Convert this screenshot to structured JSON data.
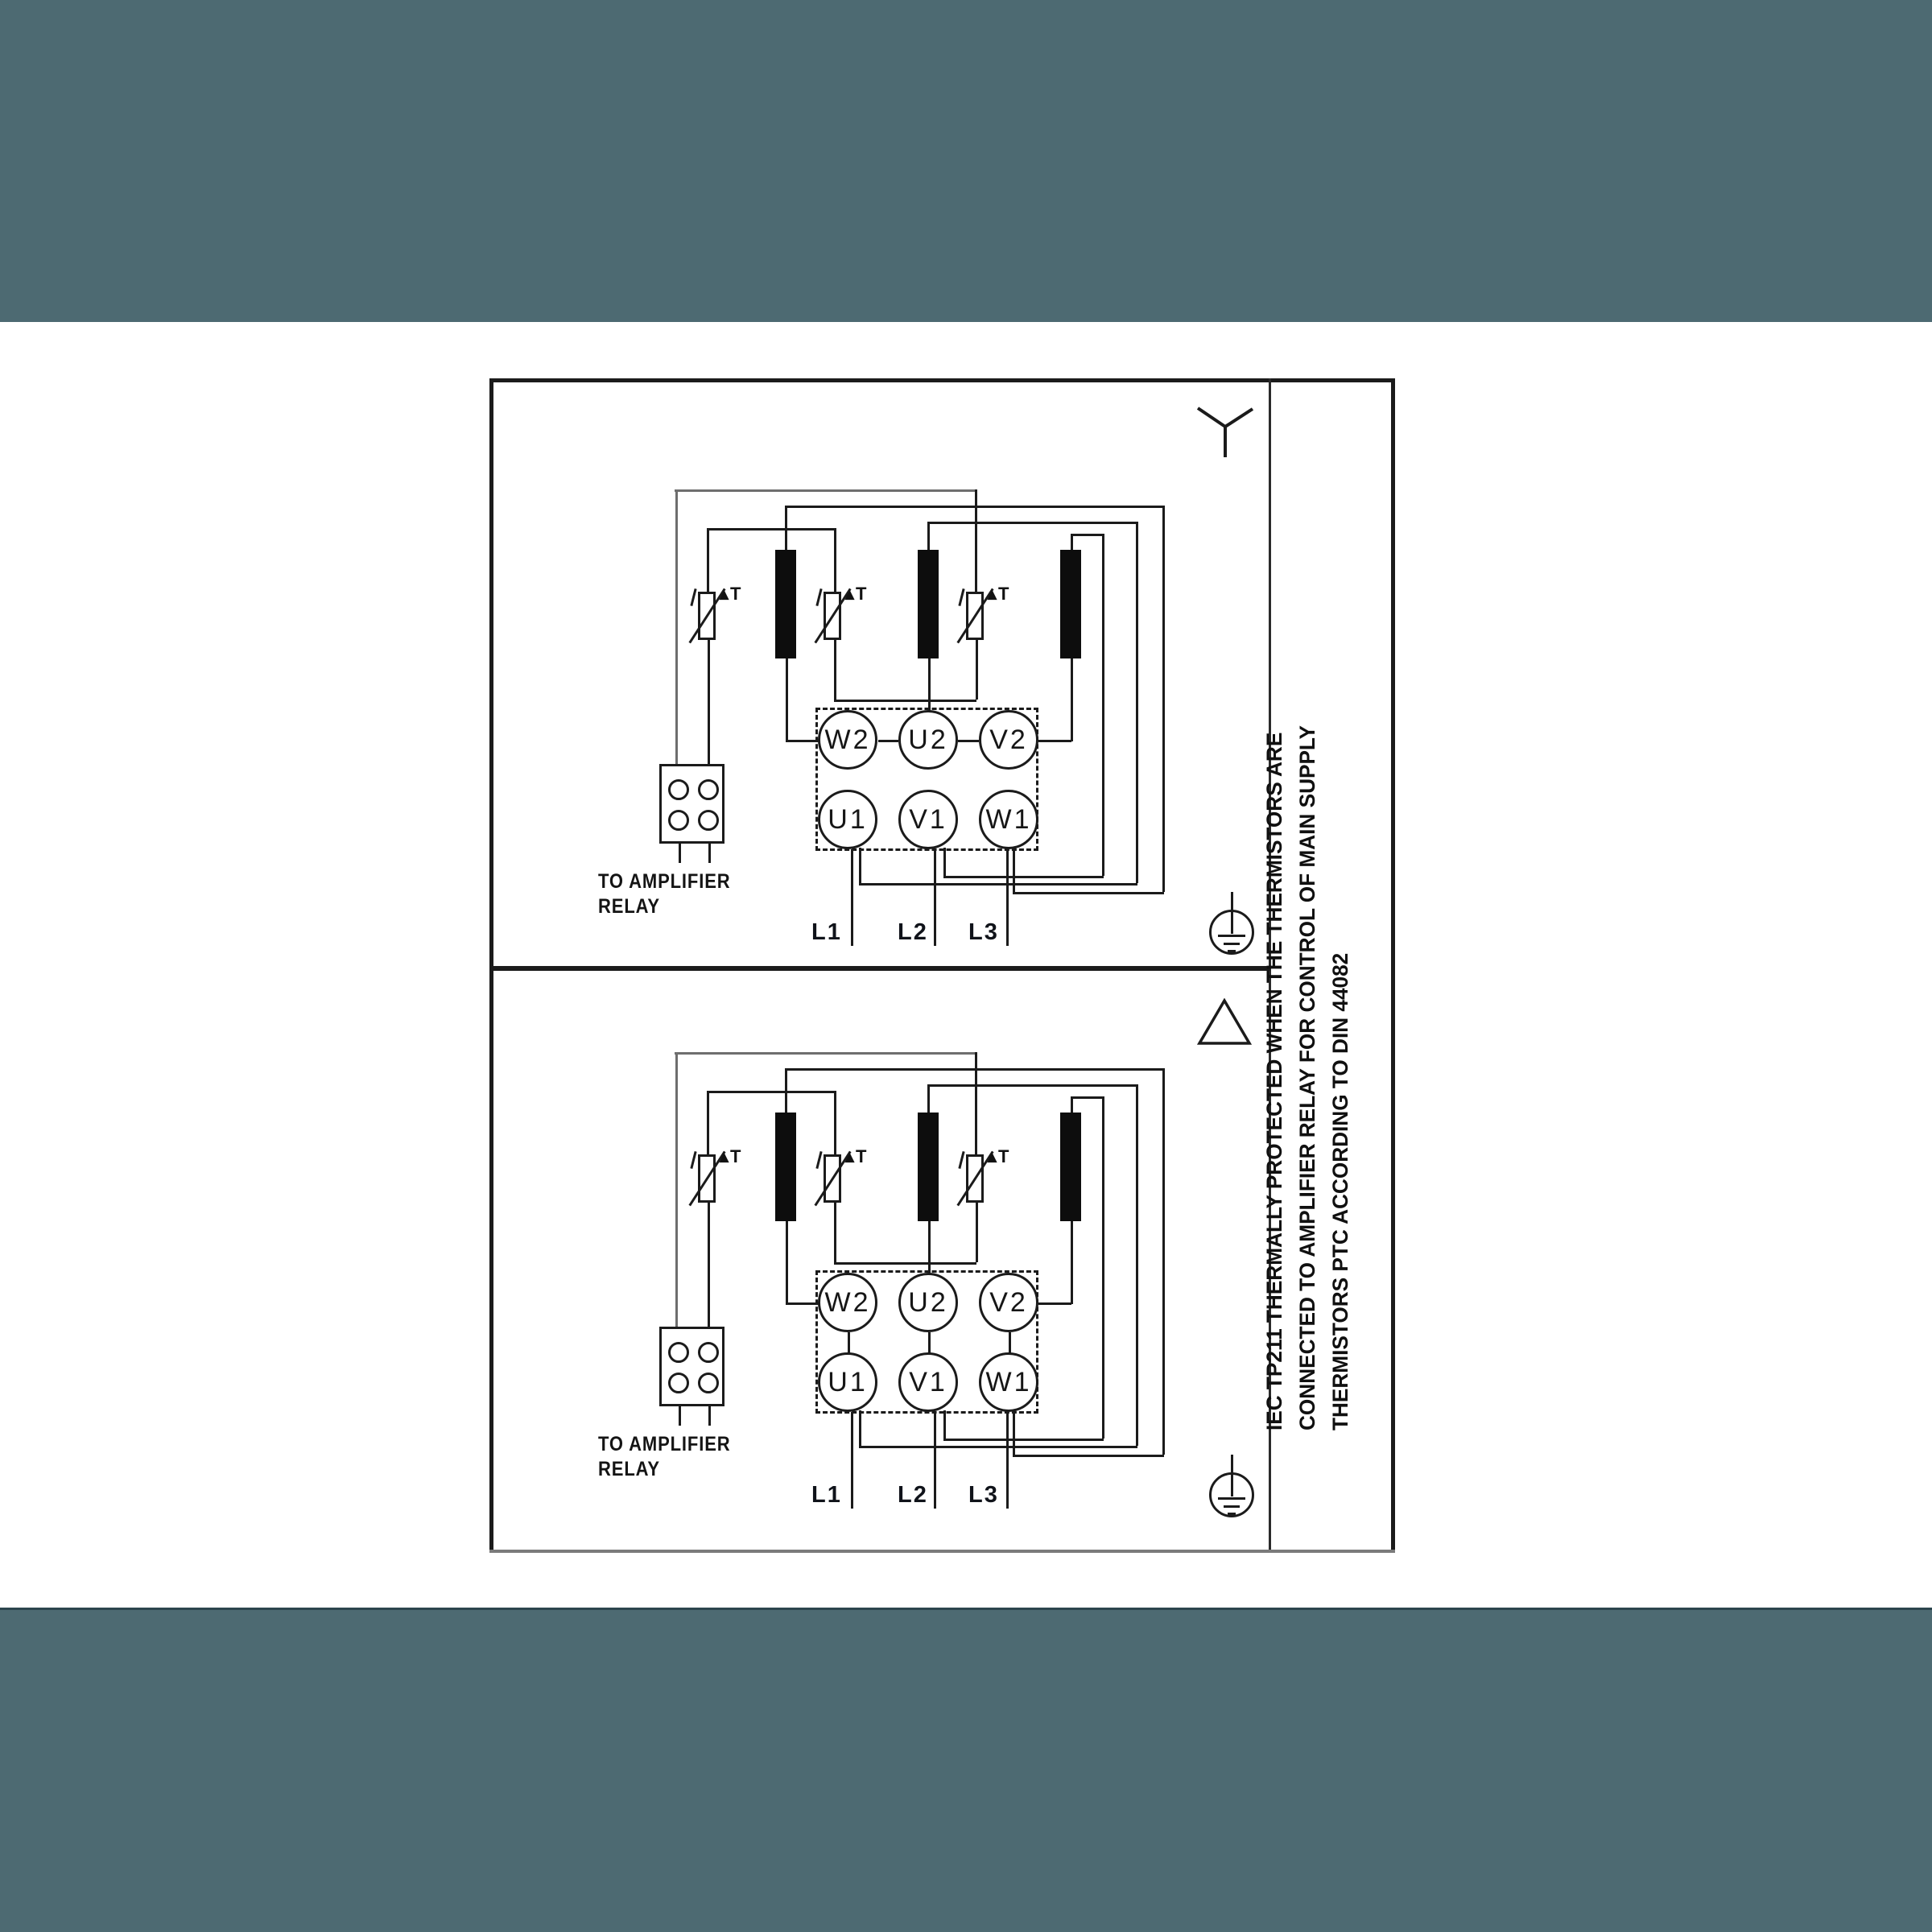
{
  "colors": {
    "band": "#4D6A72",
    "band_edge": "#2C454E",
    "paper": "#FFFFFF",
    "ink": "#1B1B1B",
    "wire_gray": "#6E6E6E",
    "border_bottom_gray": "#7B7B7B"
  },
  "diagram": {
    "side_note_lines": [
      "IEC TP211 THERMALLY PROTECTED WHEN THE THERMISTORS ARE",
      "CONNECTED TO AMPLIFIER RELAY FOR CONTROL OF MAIN SUPPLY",
      "THERMISTORS PTC ACCORDING TO DIN 44082"
    ],
    "sections": [
      {
        "id": "star-section",
        "connection_symbol": "star",
        "connection_symbol_icon": "star-connection-icon",
        "terminals_top": [
          "W2",
          "U2",
          "V2"
        ],
        "terminals_bottom": [
          "U1",
          "V1",
          "W1"
        ],
        "supply_labels": [
          "L1",
          "L2",
          "L3"
        ],
        "relay_note_line1": "TO AMPLIFIER",
        "relay_note_line2": "RELAY",
        "thermistor_label": "▴T",
        "ground_icon": "earth-ground-icon"
      },
      {
        "id": "delta-section",
        "connection_symbol": "delta",
        "connection_symbol_icon": "delta-connection-icon",
        "terminals_top": [
          "W2",
          "U2",
          "V2"
        ],
        "terminals_bottom": [
          "U1",
          "V1",
          "W1"
        ],
        "supply_labels": [
          "L1",
          "L2",
          "L3"
        ],
        "relay_note_line1": "TO AMPLIFIER",
        "relay_note_line2": "RELAY",
        "thermistor_label": "▴T",
        "ground_icon": "earth-ground-icon"
      }
    ]
  }
}
